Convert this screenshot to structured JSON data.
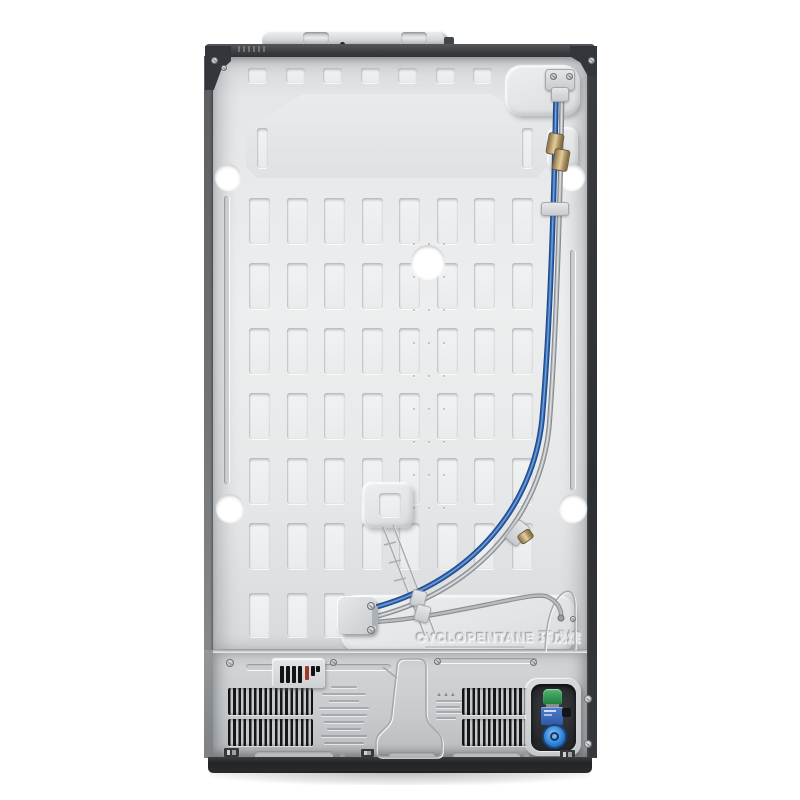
{
  "scene": {
    "description": "Rear view product photo of a refrigerator back panel on a white background",
    "background_color": "#ffffff"
  },
  "embossed_text": {
    "refrigerant": "CYCLOPENTANE 环戊烷"
  },
  "colors": {
    "panel_silver": "#e7e9ea",
    "frame_dark": "#34373a",
    "base_dark": "#232527",
    "water_tube_blue": "#3468b4",
    "tube_grey": "#aeb2b5",
    "brass_fitting": "#b89a68",
    "valve_cap_green": "#2f9e52",
    "valve_cap_blue": "#2a7dd2",
    "valve_label_blue": "#3d6fc2",
    "vent_slat_black": "#17181a",
    "grille_red_slot": "#a03828",
    "hole_white": "#ffffff"
  },
  "components": [
    "back-panel",
    "top-hinge-cover",
    "top-cap",
    "corner-brackets",
    "water-supply-tube-blue",
    "capillary-tube-grey",
    "brass-compression-fittings",
    "tube-clips",
    "tube-mounting-plate",
    "embossed-stiffening-slots",
    "mounting-holes",
    "drain-channel",
    "cyclopentane-emboss",
    "left-air-vent",
    "right-air-vent",
    "power-inlet-grille",
    "rating-label-emboss",
    "warning-label-emboss",
    "water-inlet-valve",
    "base-plinth"
  ]
}
